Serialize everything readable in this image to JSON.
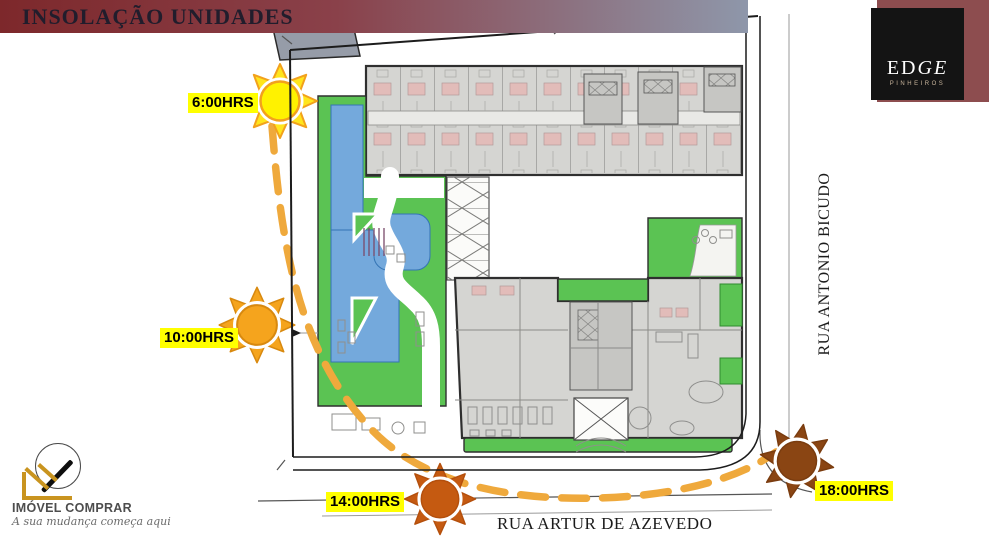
{
  "banner": {
    "title": "INSOLAÇÃO UNIDADES"
  },
  "brand": {
    "name_regular": "ED",
    "name_italic": "GE",
    "sub": "PINHEIROS"
  },
  "suns": [
    {
      "time": "6:00HRS"
    },
    {
      "time": "10:00HRS"
    },
    {
      "time": "14:00HRS"
    },
    {
      "time": "18:00HRS"
    }
  ],
  "streets": {
    "right": "RUA ANTONIO BICUDO",
    "bottom": "RUA ARTUR DE AZEVEDO"
  },
  "agency": {
    "name": "IMÓVEL COMPRAR",
    "tagline": "A sua mudança começa aqui"
  },
  "theme": {
    "banner_left": "#7D282B",
    "banner_mid": "#8A414A",
    "banner_right": "#8E97AA",
    "brand_maroon": "#8D4D4F",
    "brand_black": "#141414",
    "green": "#5BC353",
    "pool": "#74A9DC",
    "pool_edge": "#3474B4",
    "building": "#D5D5D2",
    "wall": "#2F2F2F",
    "arc": "#EFA93C",
    "label_bg": "#FFFF00",
    "sun6_core": "#FFF200",
    "sun6_rays": "#FFE51C",
    "sun6_edge": "#F2A11C",
    "sun10": "#F5A41D",
    "sun10_edge": "#D8890F",
    "sun14": "#C55A11",
    "sun14_edge": "#B44F0C",
    "sun18": "#8A4513",
    "sun18_edge": "#7A3C0F",
    "gold": "#C9941F"
  }
}
